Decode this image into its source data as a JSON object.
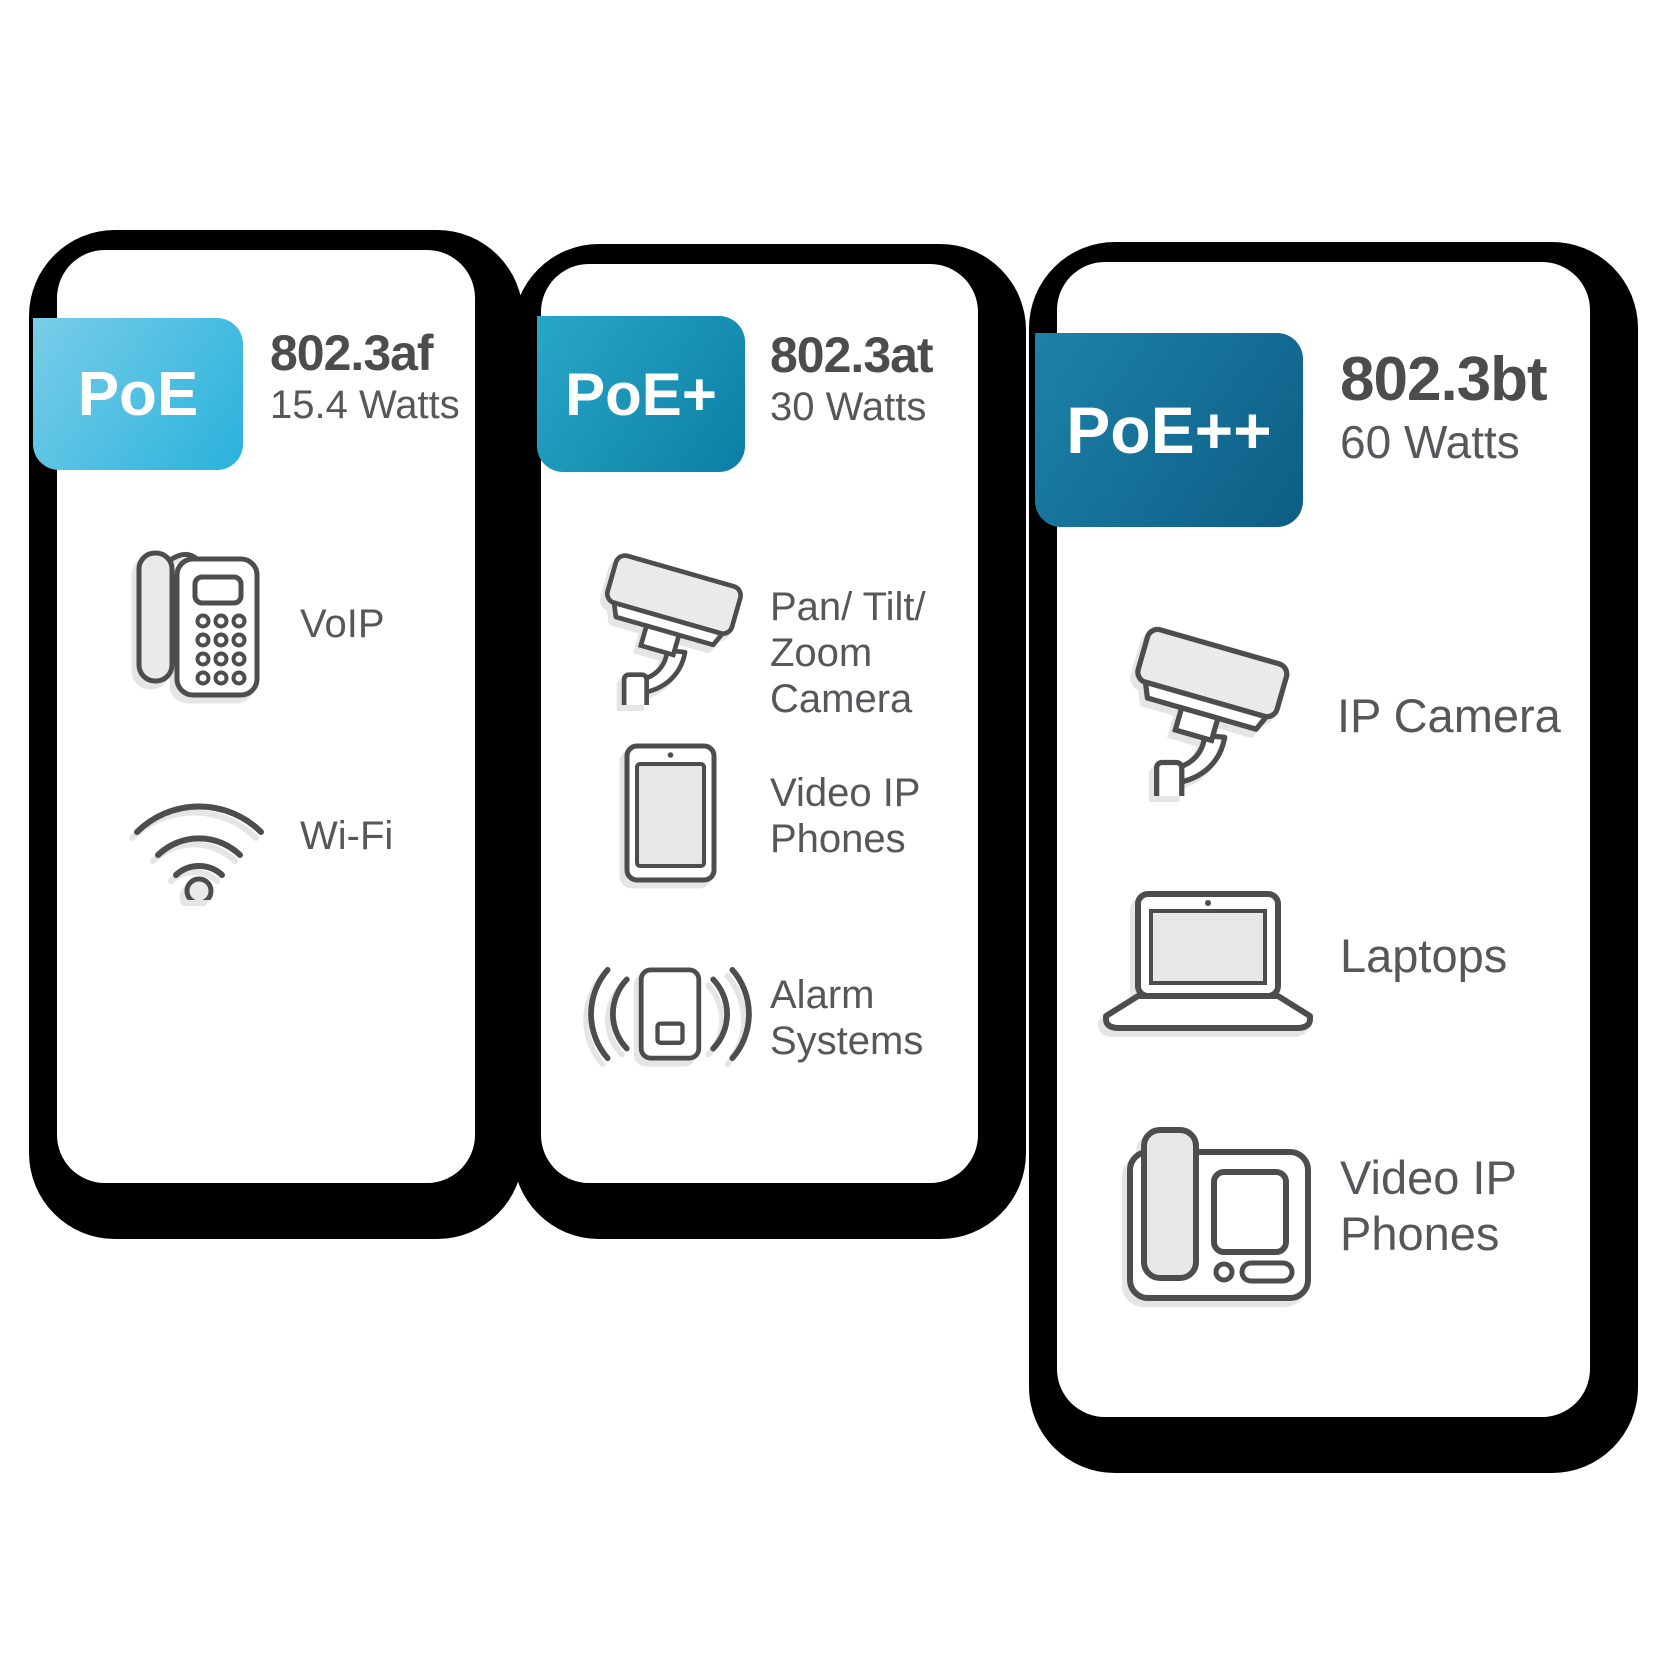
{
  "colors": {
    "shadow": "#000000",
    "title_text": "#4a4c4e",
    "body_text": "#55575b",
    "icon_stroke": "#4d4d4d",
    "icon_fill": "#eaeaea",
    "card_bg": "#ffffff"
  },
  "cards": [
    {
      "badge": "PoE",
      "badge_gradient": "linear-gradient(125deg,#79cde8 0%,#29b2dc 100%)",
      "fold_color": "#2d9dc6",
      "standard": "802.3af",
      "watts": "15.4 Watts",
      "devices": [
        {
          "icon": "voip-phone",
          "label": "VoIP"
        },
        {
          "icon": "wifi",
          "label": "Wi-Fi"
        }
      ]
    },
    {
      "badge": "PoE+",
      "badge_gradient": "linear-gradient(125deg,#28a7c7 0%,#0c7ea5 100%)",
      "fold_color": "#0a5a74",
      "standard": "802.3at",
      "watts": "30 Watts",
      "devices": [
        {
          "icon": "pan-tilt-zoom-camera",
          "label": "Pan/ Tilt/\nZoom\nCamera"
        },
        {
          "icon": "video-ip-phone-tablet",
          "label": "Video IP\nPhones"
        },
        {
          "icon": "alarm-system",
          "label": "Alarm\nSystems"
        }
      ]
    },
    {
      "badge": "PoE++",
      "badge_gradient": "linear-gradient(125deg,#1d82a8 0%,#0d5d85 100%)",
      "fold_color": "#0a455e",
      "standard": "802.3bt",
      "watts": "60 Watts",
      "devices": [
        {
          "icon": "ip-camera",
          "label": "IP Camera"
        },
        {
          "icon": "laptop",
          "label": "Laptops"
        },
        {
          "icon": "video-ip-phone",
          "label": "Video IP\nPhones"
        }
      ]
    }
  ]
}
